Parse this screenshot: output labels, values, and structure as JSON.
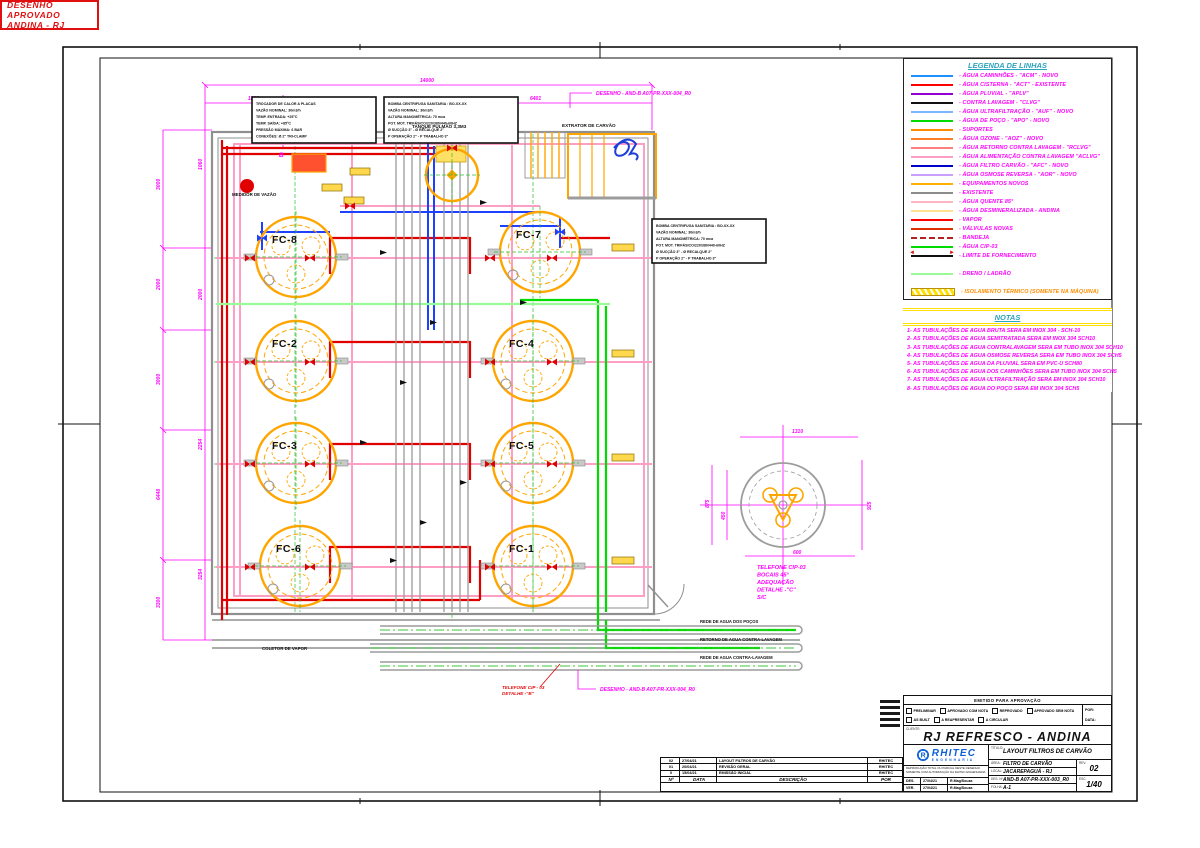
{
  "colors": {
    "magenta": "#FF00FF",
    "title_cyan": "#2BA3BE",
    "stamp_red": "#E01010",
    "brand_blue": "#0B5FD7",
    "yellow": "#FFE000"
  },
  "legend": {
    "title": "LEGENDA DE LINHAS",
    "items": [
      {
        "label": "- ÁGUA CAMINHÕES - \"ACM\" - NOVO",
        "color": "#1E90FF",
        "style": "solid"
      },
      {
        "label": "- ÁGUA CISTERNA - \"ACT\" - EXISTENTE",
        "color": "#FF0000",
        "style": "solid"
      },
      {
        "label": "- ÁGUA PLUVIAL - \"APLV\"",
        "color": "#9400D3",
        "style": "solid"
      },
      {
        "label": "- CONTRA LAVAGEM - \"CLVG\"",
        "color": "#111111",
        "style": "solid"
      },
      {
        "label": "- ÁGUA ULTRAFILTRAÇÃO - \"AUF\" - NOVO",
        "color": "#7EB6FF",
        "style": "solid"
      },
      {
        "label": "- ÁGUA DE POÇO - \"APO\" - NOVO",
        "color": "#00DC00",
        "style": "solid"
      },
      {
        "label": "- SUPORTES",
        "color": "#FF8C00",
        "style": "solid"
      },
      {
        "label": "- ÁGUA OZONE - \"AOZ\" - NOVO",
        "color": "#FF7F27",
        "style": "solid"
      },
      {
        "label": "- ÁGUA RETORNO CONTRA LAVAGEM - \"RCLVG\"",
        "color": "#FF8080",
        "style": "solid"
      },
      {
        "label": "- ÁGUA ALIMENTAÇÃO CONTRA LAVAGEM \"ACLVG\"",
        "color": "#FF9EC4",
        "style": "solid"
      },
      {
        "label": "- ÁGUA FILTRO CARVÃO - \"AFC\" - NOVO",
        "color": "#0000CD",
        "style": "solid"
      },
      {
        "label": "- ÁGUA OSMOSE REVERSA - \"AOR\" - NOVO",
        "color": "#C9A0FF",
        "style": "solid"
      },
      {
        "label": "- EQUIPAMENTOS NOVOS",
        "color": "#FFB000",
        "style": "solid"
      },
      {
        "label": "- EXISTENTE",
        "color": "#8C8C8C",
        "style": "solid"
      },
      {
        "label": "- ÁGUA QUENTE 85°",
        "color": "#FFB6C1",
        "style": "solid"
      },
      {
        "label": "- ÁGUA DESMINERALIZADA - ANDINA",
        "color": "#FFE08C",
        "style": "solid"
      },
      {
        "label": "- VAPOR",
        "color": "#FF0000",
        "style": "solid"
      },
      {
        "label": "- VÁLVULAS NOVAS",
        "color": "#E03000",
        "style": "solid"
      },
      {
        "label": "- BANDEJA",
        "color": "#B22222",
        "style": "dashed"
      },
      {
        "label": "- ÁGUA CIP-03",
        "color": "#00DC00",
        "style": "solid"
      },
      {
        "label": "- LIMITE DE FORNECIMENTO",
        "color": "#111111",
        "style": "limit"
      },
      {
        "label": "- DRENO / LADRÃO",
        "color": "#98FB98",
        "style": "solid",
        "gap": true
      },
      {
        "label": "- ISOLAMENTO TÉRMICO (SOMENTE NA MÁQUINA)",
        "color": "#FFE000",
        "style": "hatch",
        "text_color": "#FF8C00",
        "gap": true
      }
    ]
  },
  "notes": {
    "title": "NOTAS",
    "items": [
      "1- AS TUBULAÇÕES DE AGUA  BRUTA SERA EM INOX 304 - SCH-10",
      "2- AS TUBULAÇÕES DE AGUA SEMITRATADA SERA EM INOX 304 SCH10",
      "3- AS TUBULAÇÕES DE AGUA  CONTRALAVAGEM SERA  EM TUBO INOX 304 SCH10",
      "4- AS TUBULAÇÕES DE AGUA OSMOSE REVERSA SERA  EM TUBO  INOX 304 SCH5",
      "5- AS TUBULAÇÕES DE AGUA DA PLUVIAL SERA EM PVC-U SCH80",
      "6- AS TUBULAÇÕES DE AGUA DOS CAMINHÕES SERA EM TUBO INOX 304 SCH5",
      "7- AS TUBULAÇÕES DE AGUA ULTRAFILTRAÇÃO SERA EM INOX 304 SCH10",
      "8- AS TUBULAÇÕES DE AGUA DO POÇO SERA  EM INOX 304 SCH5"
    ]
  },
  "stamp": {
    "line1": "DESENHO  APROVADO",
    "line2": "ANDINA  -  RJ"
  },
  "titleblock": {
    "header": "EMITIDO PARA APROVAÇÃO",
    "checks": [
      "PRELIMINAR",
      "APROVADO COM NOTA",
      "REPROVADO",
      "APROVADO SEM NOTA",
      "AS BUILT",
      "A REAPRESENTAR",
      "A CIRCULAR"
    ],
    "por_label": "POR:",
    "data_label": "DATA:",
    "cliente_label": "CLIENTE:",
    "cliente": "RJ REFRESCO - ANDINA",
    "logo_name": "RHITEC",
    "logo_sub": "ENGENHARIA",
    "disclaimer": "REPRODUÇÃO TOTAL OU PARCIAL DESTE DESENHO SOMENTE COM AUTORIZAÇÃO DA RHITEC ENGENHARIA",
    "signs": [
      {
        "k": "DES.",
        "date": "27/04/21",
        "name": "R.Mag/Souza"
      },
      {
        "k": "VER.",
        "date": "27/04/21",
        "name": "R.Mag/Souza"
      }
    ],
    "titulo_label": "TÍTULO:",
    "titulo": "LAYOUT FILTROS DE CARVÃO",
    "area_label": "ÁREA:",
    "area": "FILTRO DE CARVÃO",
    "local_label": "LOCAL:",
    "local": "JACAREPAGUÁ - RJ",
    "des_label": "DES. Nº:",
    "des_num": "AND-B A07-PR-XXX-003_R0",
    "folha_label": "FOLHA:",
    "folha": "A-1",
    "rev_label": "REV.",
    "rev": "02",
    "esc_label": "ESC.",
    "esc": "1/40"
  },
  "revisions": {
    "headers": {
      "no": "Nº",
      "date": "DATA",
      "desc": "DESCRIÇÃO",
      "by": "POR"
    },
    "rows": [
      {
        "no": "02",
        "date": "27/04/21",
        "desc": "LAYOUT FILTROS DE CARVÃO",
        "by": "RHITEC"
      },
      {
        "no": "01",
        "date": "20/04/21",
        "desc": "REVISÃO GERAL",
        "by": "RHITEC"
      },
      {
        "no": "0",
        "date": "15/04/21",
        "desc": "EMISSÃO INICIAL",
        "by": "RHITEC"
      }
    ]
  },
  "drawing": {
    "tanks": [
      "FC-8",
      "FC-7",
      "FC-2",
      "FC-4",
      "FC-3",
      "FC-5",
      "FC-6",
      "FC-1"
    ],
    "labels": {
      "tanque_pulmao": "TANQUE PULMÃO 3,3M3",
      "extrator": "EXTRATOR DE CARVÃO",
      "medidor": "MEDIDOR DE VAZÃO",
      "coletor": "COLETOR DE VAPOR",
      "desenho_top": "DESENHO - AND-B A07-PR-XXX-004_R0",
      "desenho_bottom": "DESENHO - AND-B A07-PR-XXX-004_R0",
      "telefone_b1": "TELEFONE CIP - 03",
      "telefone_b2": "DETALHE -\"B\"",
      "ref_b": "B"
    },
    "detail_note": [
      "TELEFONE CIP-03",
      "BOCAIS 45°",
      "ADEQUAÇÃO",
      "DETALHE -\"C\"",
      "S/C"
    ],
    "pipe_labels": [
      "REDE DE AGUA DOS POÇOS",
      "RETORNO DE AGUA CONTRA-LAVAGEM",
      "REDE DE AGUA CONTRA-LAVAGEM"
    ],
    "dims": {
      "top": [
        "14000",
        "1830",
        "6401"
      ],
      "left": [
        "3000",
        "2000",
        "3000",
        "6448",
        "3300"
      ],
      "inner_left": [
        "1060",
        "2000",
        "2254",
        "3254"
      ],
      "detail": [
        "1310",
        "875",
        "450",
        "925",
        "600"
      ]
    },
    "spec_boxes": [
      {
        "lines": [
          "TROCADOR DE CALOR A PLACAS",
          "VAZÃO NOMINAL: 30m3/h",
          "TEMP. ENTRADA: +25°C",
          "TEMP. SAÍDA: +85°C",
          "PRESSÃO MÁXIMA: 6 BAR",
          "CONEXÕES: Ø 2\" TRI-CLAMP"
        ]
      },
      {
        "lines": [
          "BOMBA CENTRIFUGA SANITARIA : BO-XX-XX",
          "VAZÃO NOMINAL: 30m3/h",
          "ALTURA MANOMÉTRICA: 70 mca",
          "POT. MOT. TRIFÁSICO/220/380/440-60HZ",
          "Ø SUCÇÃO 3\" - Ø RECALQUE 2\"",
          "P OPERAÇÃO 2\" - P TRABALHO 3\""
        ]
      },
      {
        "lines": [
          "BOMBA CENTRIFUGA SANITARIA : BO-XX-XX",
          "VAZÃO NOMINAL: 30m3/h",
          "ALTURA MANOMÉTRICA: 70 mca",
          "POT. MOT. TRIFÁSICO/220/380/440-60HZ",
          "Ø SUCÇÃO 3\" - Ø RECALQUE 2\"",
          "P OPERAÇÃO 2\" - P TRABALHO 3\""
        ]
      }
    ]
  }
}
